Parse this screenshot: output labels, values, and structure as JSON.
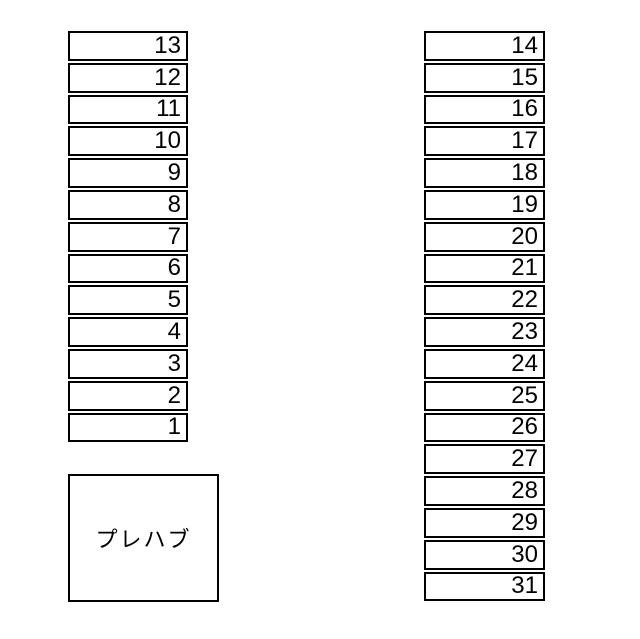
{
  "map": {
    "left_column": {
      "cells": [
        "13",
        "12",
        "11",
        "10",
        "9",
        "8",
        "7",
        "6",
        "5",
        "4",
        "3",
        "2",
        "1"
      ]
    },
    "right_column": {
      "cells": [
        "14",
        "15",
        "16",
        "17",
        "18",
        "19",
        "20",
        "21",
        "22",
        "23",
        "24",
        "25",
        "26",
        "27",
        "28",
        "29",
        "30",
        "31"
      ]
    },
    "prefab": {
      "label": "プレハブ"
    },
    "colors": {
      "background": "#ffffff",
      "border": "#000000",
      "text": "#000000"
    }
  }
}
